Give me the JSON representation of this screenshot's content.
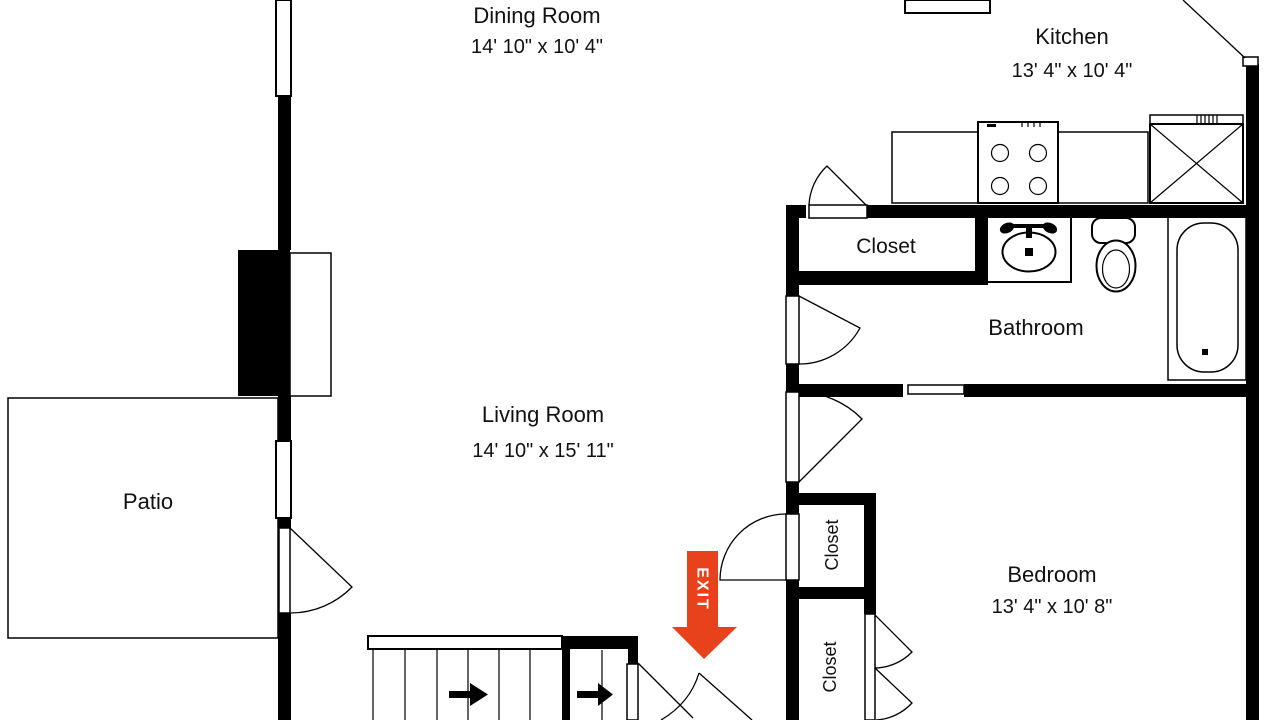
{
  "plan": {
    "rooms": {
      "dining": {
        "name": "Dining Room",
        "dims": "14' 10\" x 10' 4\""
      },
      "kitchen": {
        "name": "Kitchen",
        "dims": "13' 4\" x 10' 4\""
      },
      "living": {
        "name": "Living Room",
        "dims": "14' 10\" x 15' 11\""
      },
      "bedroom": {
        "name": "Bedroom",
        "dims": "13' 4\" x 10' 8\""
      },
      "patio": {
        "name": "Patio"
      },
      "bathroom": {
        "name": "Bathroom"
      },
      "closet_hall": {
        "name": "Closet"
      },
      "closet_upper": {
        "name": "Closet"
      },
      "closet_lower": {
        "name": "Closet"
      }
    },
    "exit_label": "EXIT",
    "colors": {
      "walls": "#000000",
      "background": "#FFFFFF",
      "exit_arrow": "#E8421C"
    }
  }
}
